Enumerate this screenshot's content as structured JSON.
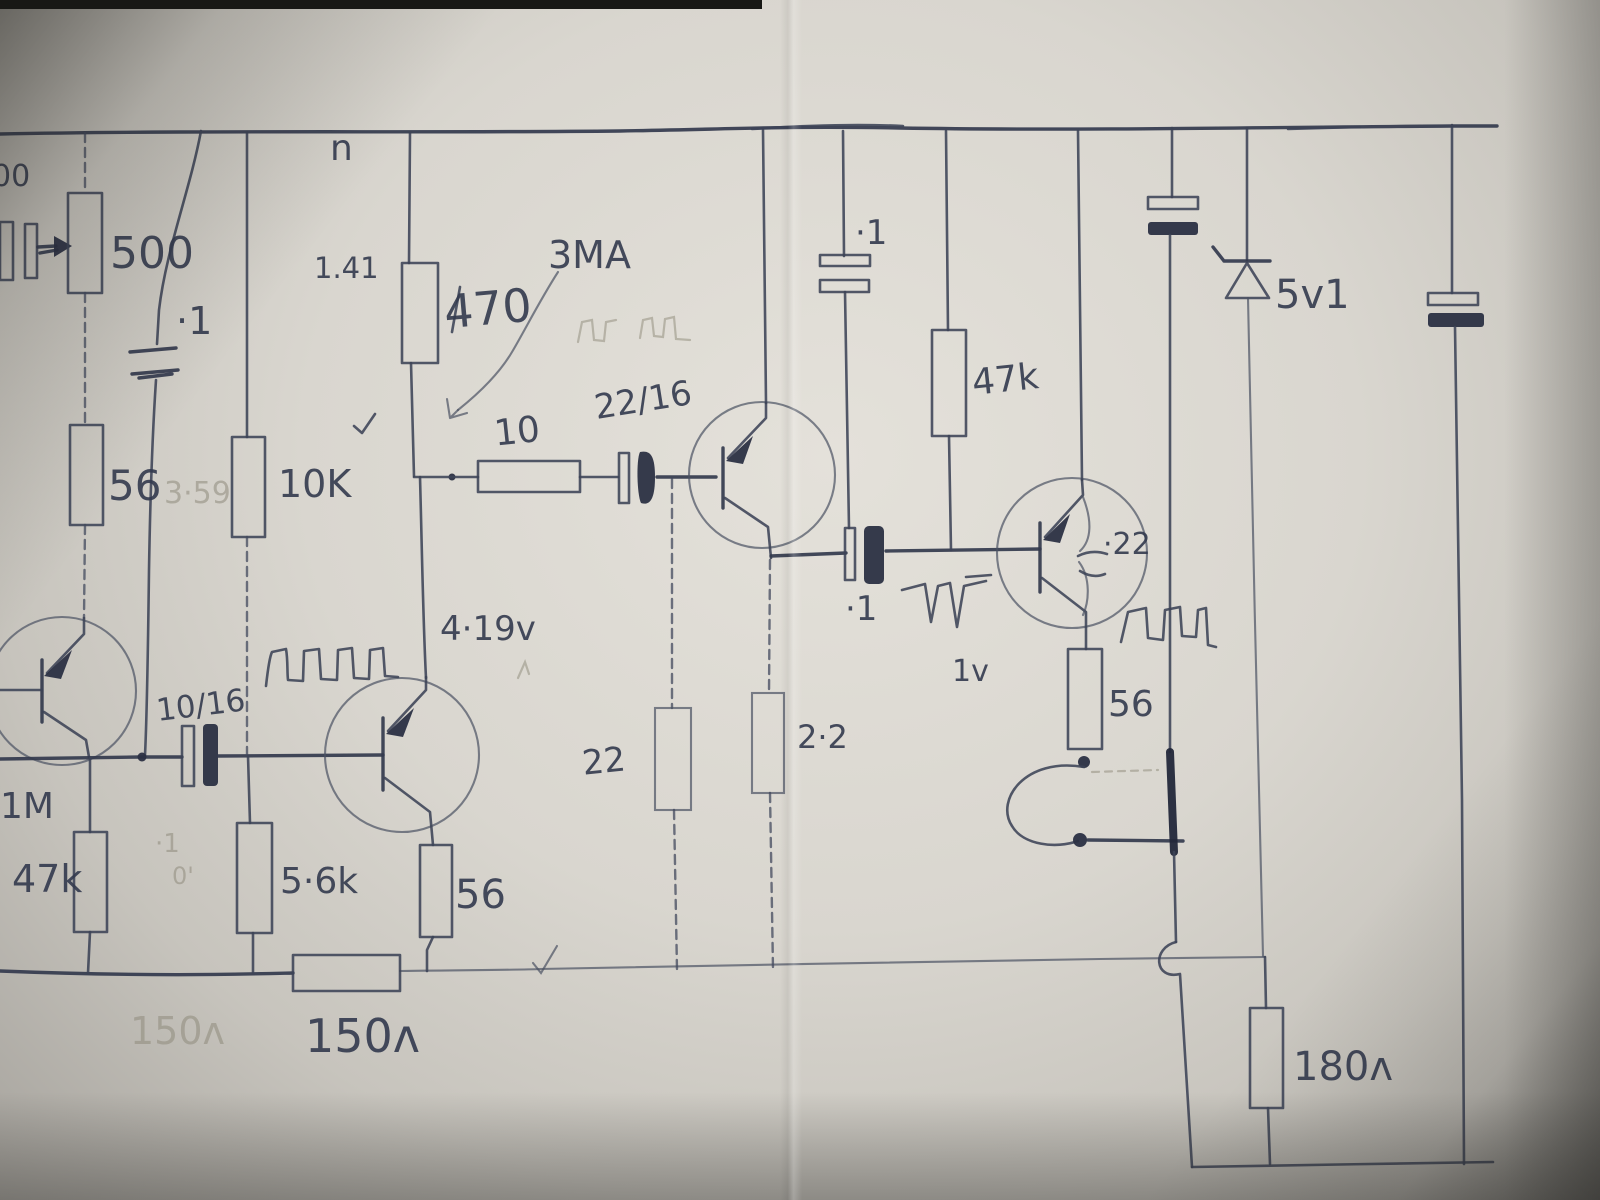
{
  "title": "Hand-drawn 4-transistor circuit schematic (pencil and ink on creased paper)",
  "labels": {
    "n_mark": "n",
    "c00_edge": "00",
    "pot500": "500",
    "cap_in_01": "·1",
    "v141": "1.41",
    "r470": "470",
    "i3ma": "3MA",
    "c2216": "22/16",
    "r10": "10",
    "r56_left": "56",
    "p359": "3·59",
    "r10k": "10K",
    "c1016": "10/16",
    "r1m": "1M",
    "r47k_left": "47k",
    "pencil_01": "·1",
    "pencil_0q": "0'",
    "r5k6": "5·6k",
    "r56_q2": "56",
    "r22": "22",
    "r2_2": "2·2",
    "c01_couple": "·1",
    "v419": "4·19v",
    "r47k_right": "47k",
    "c01_top": "·1",
    "c022": "·22",
    "v1": "1v",
    "r56_right": "56",
    "zener": "5v1",
    "r150": "150ʌ",
    "p150": "150ʌ",
    "r180": "180ʌ"
  },
  "components": {
    "resistors": [
      "500 (pot with wiper arrow)",
      "56",
      "10K",
      "470",
      "10",
      "1M",
      "47k",
      "5.6k",
      "56",
      "22",
      "2.2",
      "47k",
      "56",
      "150Ω",
      "180Ω"
    ],
    "capacitors": [
      "·1 (input)",
      "·1 (near pot)",
      "22/16 electrolytic",
      "10/16 electrolytic",
      "·1 (bypass to rail)",
      "·1 (coupling)",
      "·22 (inside output transistor)",
      "electrolytic at top right (unlabeled)",
      "electrolytic at far right (unlabeled)"
    ],
    "semiconductors": [
      "4 PNP transistors (circle symbols, arrow into base bar)",
      "zener diode 5v1"
    ],
    "annotations": [
      "3MA current note",
      "1.41 voltage note",
      "3·59 pencil voltage",
      "4·19v voltage note",
      "1v level note",
      "square-wave sketches (3 ink, 1 faint pencil)",
      "spike-waveform sketch",
      "checkmarks",
      "curved arrow pointing at 470/10 junction",
      "wire loop link below right 56 resistor",
      "hop where wire crosses ground rail"
    ]
  }
}
